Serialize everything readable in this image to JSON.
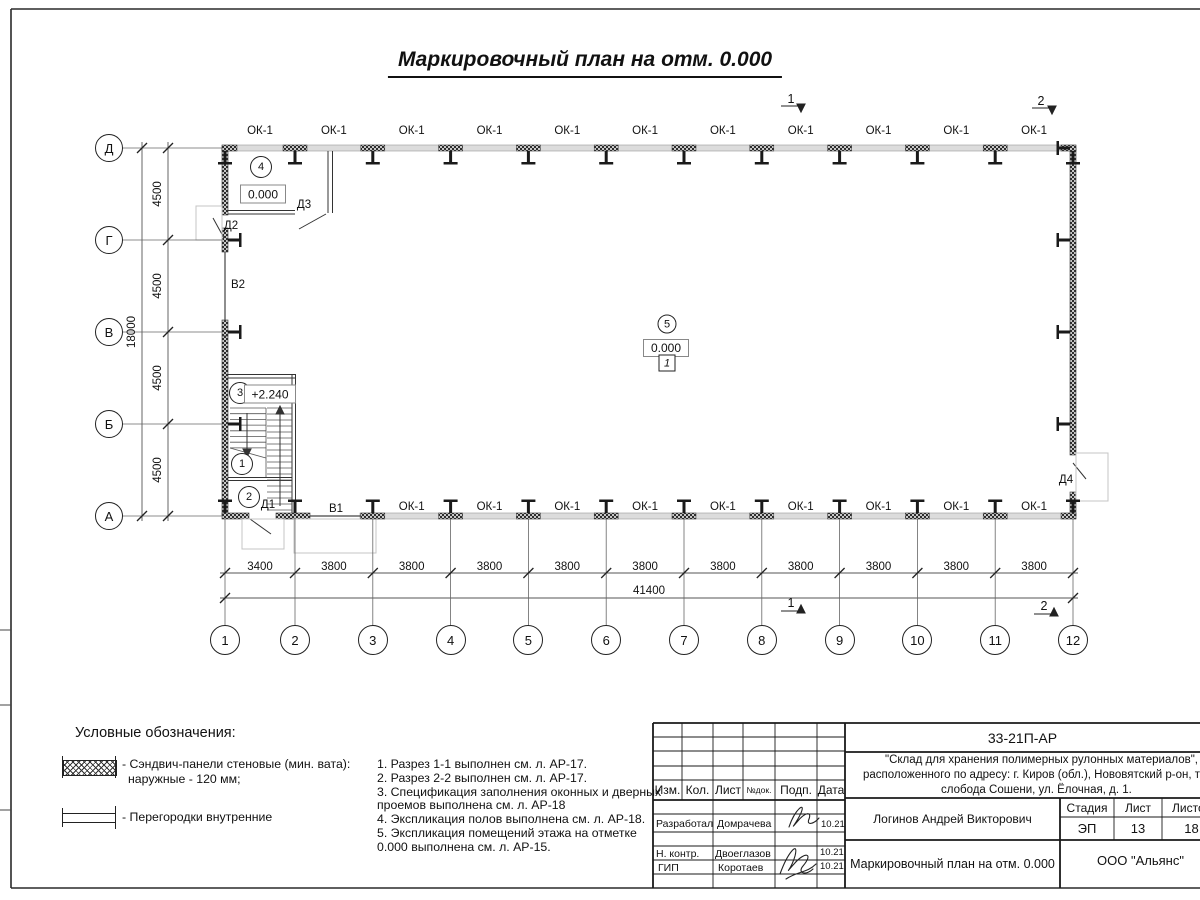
{
  "sheet_title": "Маркировочный план на отм. 0.000",
  "plan": {
    "window_label": "ОК-1",
    "grid": {
      "bottom_labels": [
        "1",
        "2",
        "3",
        "4",
        "5",
        "6",
        "7",
        "8",
        "9",
        "10",
        "11",
        "12"
      ],
      "left_labels": [
        "Д",
        "Г",
        "В",
        "Б",
        "А"
      ]
    },
    "dimensions": {
      "bottom_segments": [
        "3400",
        "3800",
        "3800",
        "3800",
        "3800",
        "3800",
        "3800",
        "3800",
        "3800",
        "3800",
        "3800"
      ],
      "bottom_total": "41400",
      "left_segments": [
        "4500",
        "4500",
        "4500",
        "4500"
      ],
      "left_total": "18000"
    },
    "openings": [
      {
        "label": "Д3"
      },
      {
        "label": "Д2"
      },
      {
        "label": "В2"
      },
      {
        "label": "Д1"
      },
      {
        "label": "В1"
      },
      {
        "label": "Д4"
      }
    ],
    "room_tags": [
      "4",
      "3",
      "1",
      "2",
      "5"
    ],
    "elevations": [
      "0.000",
      "+2.240",
      "0.000"
    ],
    "floor_type": "1",
    "section_markers": [
      "1",
      "2",
      "1",
      "2"
    ]
  },
  "legend": {
    "header": "Условные обозначения:",
    "item1_line1": "- Сэндвич-панели стеновые (мин. вата):",
    "item1_line2": "наружные - 120 мм;",
    "item2_line1": "- Перегородки внутренние"
  },
  "notes_lines": [
    "1. Разрез 1-1 выполнен см. л. АР-17.",
    "2. Разрез 2-2 выполнен см. л. АР-17.",
    "3. Спецификация заполнения оконных и дверных",
    "проемов выполнена см. л. АР-18",
    "4. Экспликация полов выполнена см. л. АР-18.",
    "5. Экспликация помещений этажа на отметке",
    "0.000 выполнена см. л. АР-15."
  ],
  "titleblock": {
    "doc_number": "33-21П-АР",
    "project_line1": "\"Склад для хранения полимерных рулонных материалов\",",
    "project_line2": "расположенного по адресу: г. Киров (обл.), Нововятский р-он, те",
    "project_line3": "слобода Сошени, ул. Ёлочная, д. 1.",
    "header_cells": [
      "Изм.",
      "Кол.",
      "Лист",
      "№док.",
      "Подп.",
      "Дата"
    ],
    "rows": [
      {
        "role": "Разработал",
        "name": "Домрачева",
        "date": "10.21"
      },
      {
        "role": "Н. контр.",
        "name": "Двоеглазов",
        "date": "10.21"
      },
      {
        "role": "ГИП",
        "name": "Коротаев",
        "date": "10.21"
      }
    ],
    "author": "Логинов Андрей Викторович",
    "stage_label": "Стадия",
    "sheet_label": "Лист",
    "sheets_label": "Листов",
    "stage_value": "ЭП",
    "sheet_value": "13",
    "sheets_value": "18",
    "drawing_title": "Маркировочный план на отм. 0.000",
    "company": "ООО \"Альянс\""
  }
}
